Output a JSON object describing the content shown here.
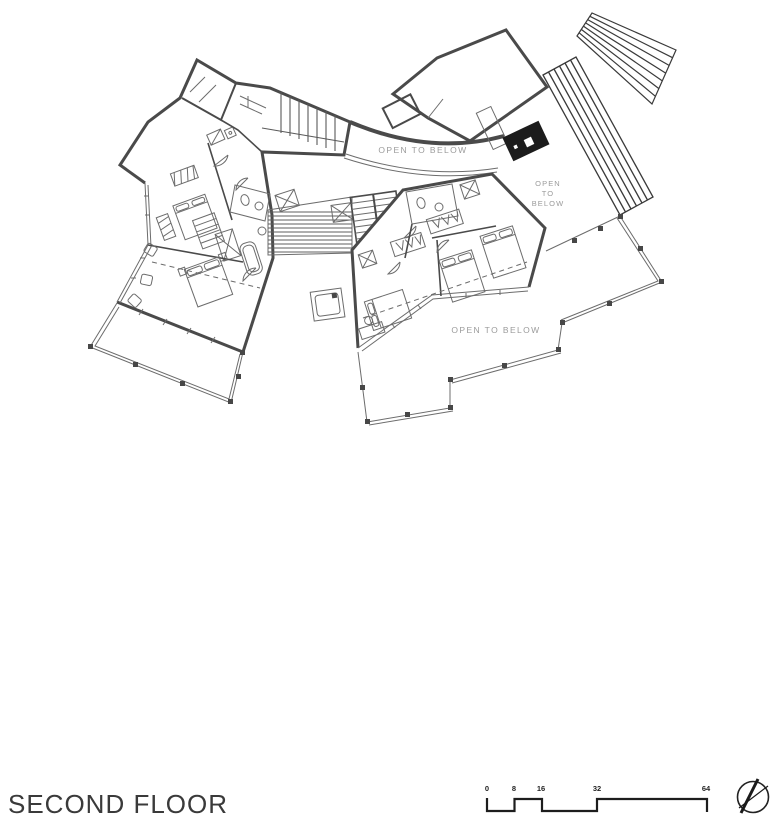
{
  "page": {
    "background": "#ffffff"
  },
  "title": {
    "text": "SECOND FLOOR"
  },
  "plan": {
    "labels": {
      "gallery": "OPEN TO BELOW",
      "courtyard_line1": "OPEN",
      "courtyard_line2": "TO",
      "courtyard_line3": "BELOW",
      "terrace": "OPEN TO BELOW"
    },
    "colors": {
      "wall": "#4a4a4a",
      "thin_line": "#6c6c6c",
      "label_text": "#9b9b9b",
      "fireplace_fill": "#1c1c1c",
      "title_text": "#3a3a3a",
      "scale_text": "#222222"
    }
  },
  "scale_bar": {
    "ticks": [
      "0",
      "8",
      "16",
      "32",
      "64"
    ]
  },
  "icons": {
    "north_arrow": "compass-circle-with-cross"
  }
}
